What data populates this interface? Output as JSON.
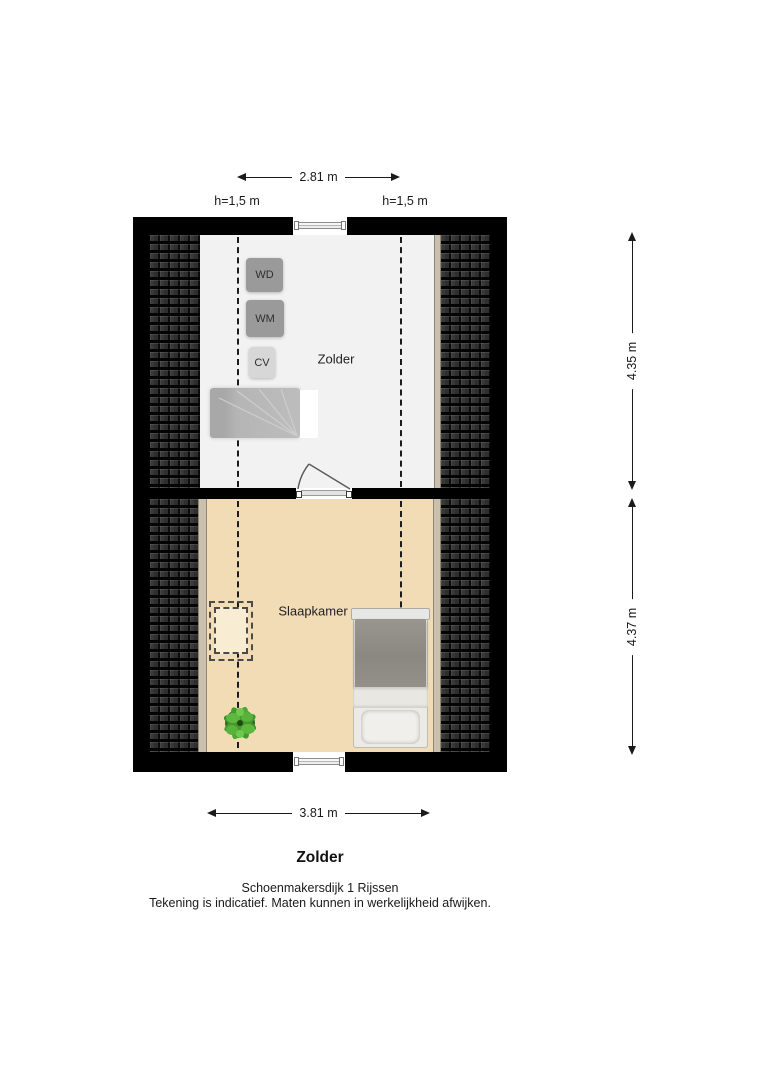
{
  "plan": {
    "rooms": {
      "attic": {
        "label": "Zolder"
      },
      "bedroom": {
        "label": "Slaapkamer"
      }
    },
    "appliances": [
      {
        "label": "WD"
      },
      {
        "label": "WM"
      },
      {
        "label": "CV"
      }
    ],
    "dimensions": {
      "attic_width": "2.81 m",
      "bedroom_width": "3.81 m",
      "attic_depth": "4.35 m",
      "bedroom_depth": "4.37 m",
      "knee_wall_height_left": "h=1,5 m",
      "knee_wall_height_right": "h=1,5 m"
    },
    "icons": [
      "roof-tiles-icon",
      "staircase-icon",
      "door-swing-icon",
      "skylight-icon",
      "bed-icon",
      "plant-icon",
      "window-icon"
    ],
    "colors": {
      "wall": "#000000",
      "roof_tiles": "#2e2e2e",
      "attic_floor": "#f2f2f2",
      "bedroom_floor": "#f1dcb5",
      "knee_strip": "#cbbfae",
      "appliance_gray": "#9a9a9a",
      "plant_green": "#4ea832"
    }
  },
  "footer": {
    "title": "Zolder",
    "address": "Schoenmakersdijk 1 Rijssen",
    "disclaimer": "Tekening is indicatief. Maten kunnen in werkelijkheid afwijken."
  }
}
